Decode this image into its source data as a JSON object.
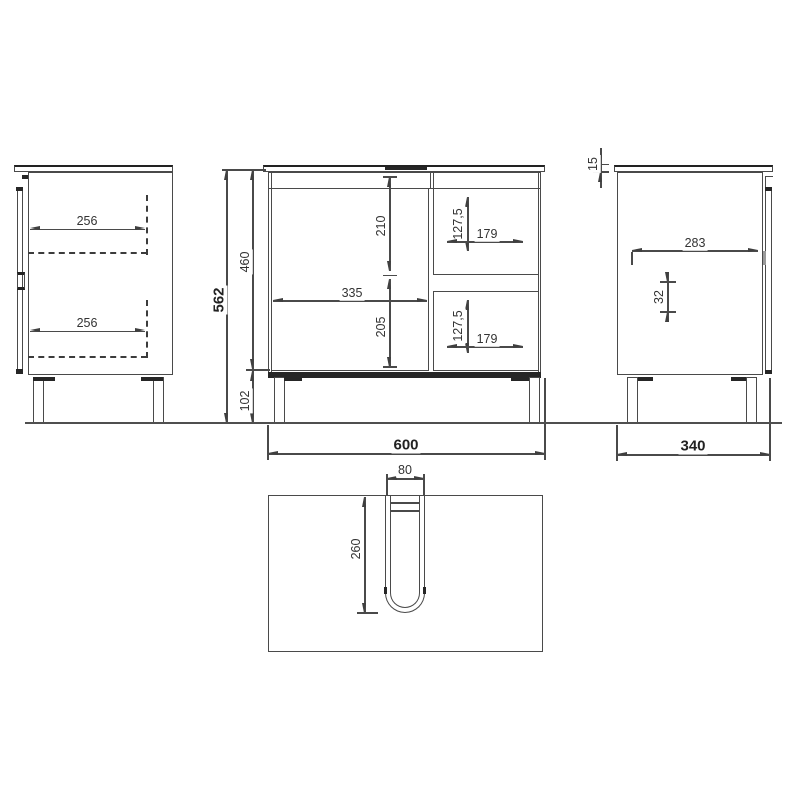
{
  "drawing": {
    "type": "furniture-dimension-diagram",
    "subject": "bathroom vanity cabinet with door and two drawers",
    "colors": {
      "line": "#4a4a4a",
      "dark_line": "#222222",
      "dimension": "#3f3f3f",
      "background": "#ffffff"
    },
    "views": {
      "left_side": {
        "name": "left side view",
        "dims": {
          "shelf_top": "256",
          "shelf_bottom": "256"
        }
      },
      "front": {
        "name": "front view",
        "dims": {
          "height_total": "562",
          "height_body": "460",
          "height_legs": "102",
          "door_upper": "210",
          "door_lower": "205",
          "door_width": "335",
          "drawer_top_height": "127,5",
          "drawer_top_width": "179",
          "drawer_bottom_height": "127,5",
          "drawer_bottom_width": "179",
          "width_total": "600"
        }
      },
      "right_side": {
        "name": "right side view",
        "dims": {
          "top_thickness": "15",
          "depth_inner": "283",
          "hole_spacing": "32",
          "depth_total": "340"
        }
      },
      "plan": {
        "name": "top view",
        "dims": {
          "cutout_width": "80",
          "cutout_depth": "260"
        }
      }
    }
  }
}
